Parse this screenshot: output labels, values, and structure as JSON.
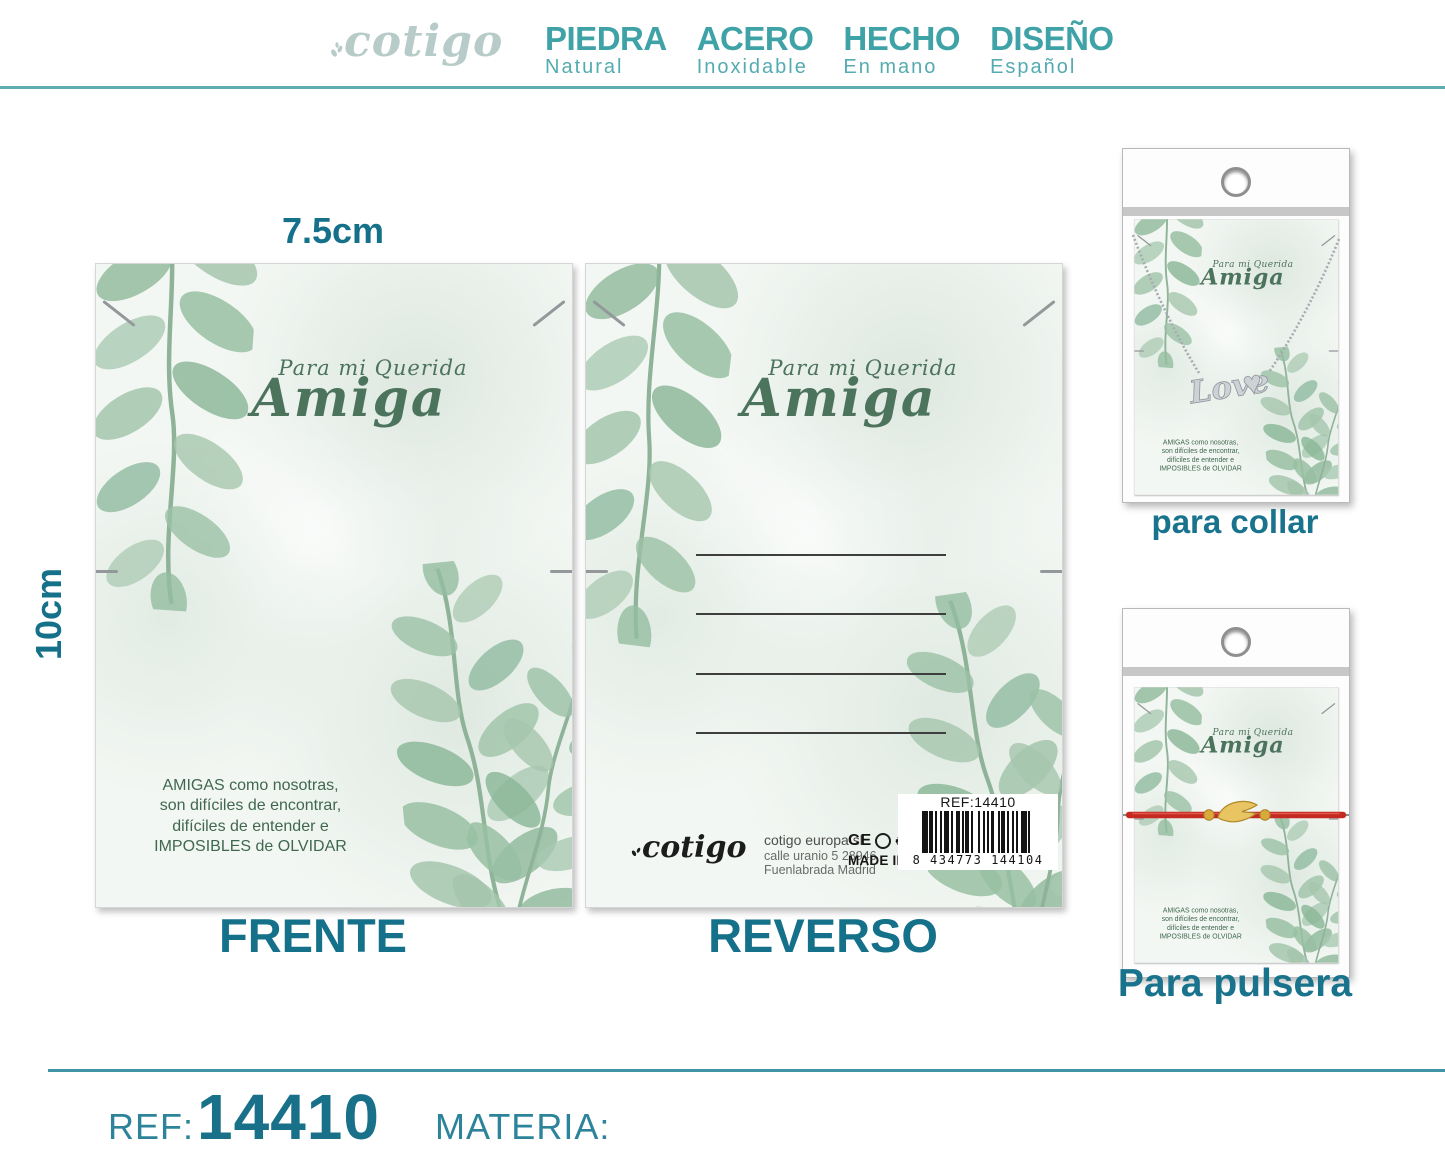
{
  "header": {
    "logo": "cotigo",
    "badges": [
      {
        "title": "PIEDRA",
        "subtitle": "Natural"
      },
      {
        "title": "ACERO",
        "subtitle": "Inoxidable"
      },
      {
        "title": "HECHO",
        "subtitle": "En mano"
      },
      {
        "title": "DISEÑO",
        "subtitle": "Español"
      }
    ]
  },
  "measurements": {
    "width": "7.5cm",
    "height": "10cm"
  },
  "card_front": {
    "caption": "FRENTE",
    "dedication_script": "Para mi Querida",
    "dedication_name": "Amiga",
    "quote_lines": [
      "AMIGAS como nosotras,",
      "son difíciles de encontrar,",
      "difíciles de entender e",
      "IMPOSIBLES de OLVIDAR"
    ]
  },
  "card_back": {
    "caption": "REVERSO",
    "brand": "cotigo",
    "company_lines": [
      "cotigo europa sl",
      "calle uranio 5 28946",
      "Fuenlabrada Madrid"
    ],
    "ce_mark": "CE",
    "made_in": "MADE IN P.R.C",
    "barcode_ref": "REF:14410",
    "barcode_digits": "8 434773 144104"
  },
  "products": {
    "necklace": {
      "caption": "para collar",
      "pendant_text": "Love"
    },
    "bracelet": {
      "caption": "Para pulsera"
    }
  },
  "footer": {
    "ref_label": "REF:",
    "ref_value": "14410",
    "materia_label": "MATERIA:"
  },
  "colors": {
    "teal_badge": "#3fa2a6",
    "teal_dark": "#15708a",
    "logo_gray": "#b7cbc8",
    "leaf_green": "#97bda1",
    "script_green": "#4c735c",
    "quote_green": "#40684f",
    "cord_red": "#c52a22",
    "gold": "#d9a93c",
    "barcode_black": "#141414"
  }
}
